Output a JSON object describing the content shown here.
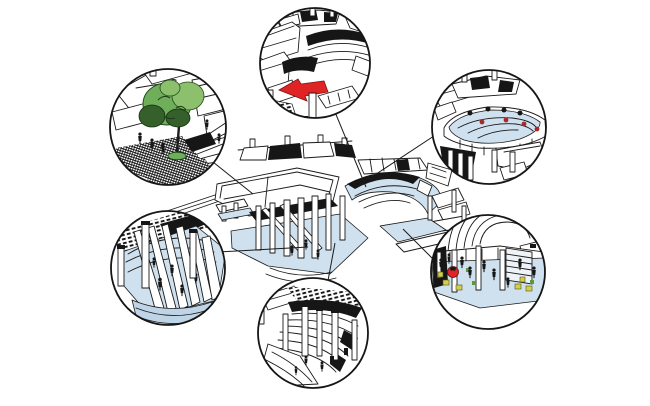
{
  "diagram": {
    "type": "architectural-detail-callout-diagram",
    "central_drawing": "isometric-building-model",
    "callouts": [
      {
        "id": "terrace-red-arrow-detail",
        "position": "top-center",
        "accent": "red-arrow"
      },
      {
        "id": "roof-terrace-red-dots-detail",
        "position": "top-right",
        "accent": "red-dots"
      },
      {
        "id": "plaza-tree-detail",
        "position": "left",
        "accent": "green-tree"
      },
      {
        "id": "stepped-seating-columns-detail",
        "position": "lower-left",
        "accent": "blue-steps"
      },
      {
        "id": "ribbed-structure-detail",
        "position": "bottom-center",
        "accent": "none"
      },
      {
        "id": "interior-seating-detail",
        "position": "right",
        "accent": "red-table-yellow-chairs"
      }
    ]
  },
  "colors": {
    "background": "#ffffff",
    "line": "#1a1a1a",
    "highlight_blue": "#cfe0ee",
    "highlight_blue_deep": "#bfd4e6",
    "accent_red": "#e02426",
    "accent_red_dark": "#a9282d",
    "tree_green": "#6fae5a",
    "tree_green_light": "#8cc06c",
    "tree_green_dark": "#35602b",
    "chair_yellow": "#d2cf4a",
    "accent_green_small": "#5a9a3c",
    "stair_panel": "#eef3f8"
  }
}
